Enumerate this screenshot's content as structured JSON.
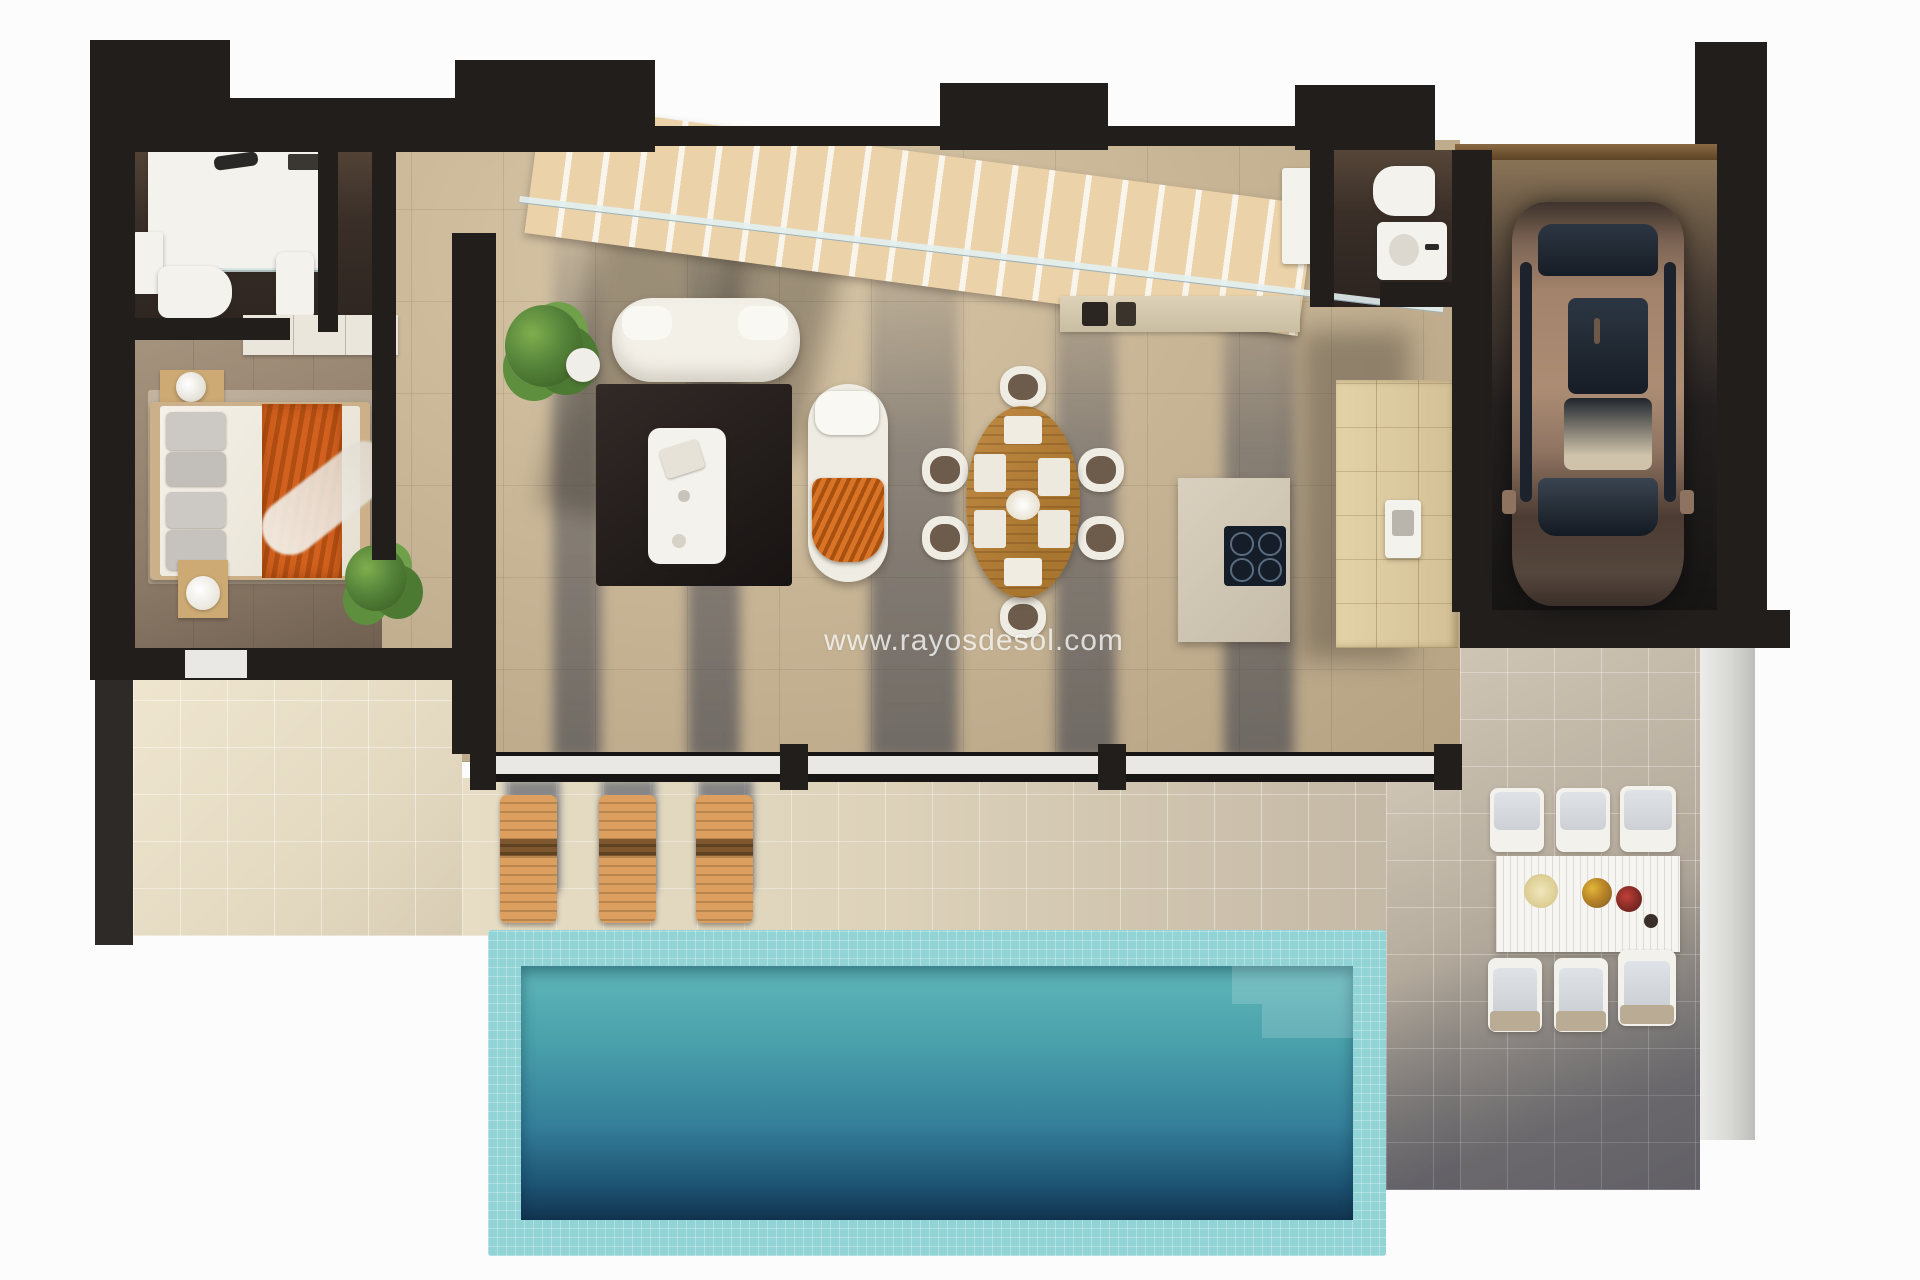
{
  "watermark": {
    "text": "www.rayosdesol.com",
    "color": "#ffffff"
  },
  "scene": {
    "kind": "3d-floor-plan-render",
    "description": "Top-down 3D render of a villa ground floor with terrace and pool",
    "rooms": [
      {
        "name": "bathroom",
        "fixtures": [
          "shower",
          "toilet",
          "vanity-sink",
          "bathtub"
        ]
      },
      {
        "name": "bedroom",
        "furniture": [
          "double-bed",
          "orange-blanket",
          "nightstand-with-lamp",
          "nightstand-with-tray",
          "rug",
          "plant",
          "wardrobe"
        ]
      },
      {
        "name": "living-room",
        "furniture": [
          "sofa",
          "chaise-lounge",
          "coffee-table",
          "dark-rug",
          "plant",
          "staircase",
          "glass-railing"
        ]
      },
      {
        "name": "dining-area",
        "furniture": [
          "oval-wood-table",
          "dining-chairs"
        ],
        "chair_count": 6
      },
      {
        "name": "kitchen",
        "furniture": [
          "island-with-cooktop",
          "wall-counter",
          "cabinet-run",
          "sink",
          "tall-appliance"
        ]
      },
      {
        "name": "guest-wc",
        "fixtures": [
          "toilet",
          "sink"
        ]
      },
      {
        "name": "garage",
        "contents": [
          "car"
        ]
      },
      {
        "name": "terrace",
        "furniture": [
          "sun-loungers",
          "outdoor-dining-table",
          "outdoor-chairs"
        ],
        "lounger_count": 3,
        "outdoor_chair_count": 6
      },
      {
        "name": "pool",
        "features": [
          "mosaic-border",
          "corner-steps"
        ]
      }
    ]
  },
  "palette": {
    "background": "#fcfcfc",
    "walls": "#211e1c",
    "marble_floor": "#c7b495",
    "terrace_left": "#e4dac2",
    "terrace_right": "#9b958b",
    "pool_border": "#92d4d6",
    "pool_water_top": "#5fb6b8",
    "pool_water_bottom": "#12344f",
    "lounger_wood": "#dd9f5f",
    "stair_wood": "#ecd2a8",
    "dining_table_wood": "#b5803f",
    "bed_blanket_orange": "#d2601e",
    "chaise_throw_orange": "#c96a2a",
    "car_body": "#a3836b",
    "cabinet_wood": "#dcca9f"
  }
}
